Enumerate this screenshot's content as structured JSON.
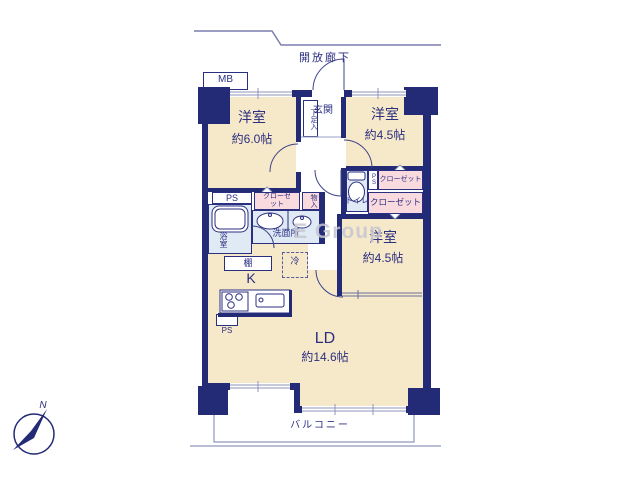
{
  "colors": {
    "wall": "#232a76",
    "room_fill": "#f6e9ca",
    "closet_fill": "#f9dade",
    "wet_area_fill": "#dfeaf4",
    "thin_line": "#8f96bb",
    "label_text": "#2b2f80",
    "watermark_text": "#c6c6d0"
  },
  "labels": {
    "open_corridor": "開放廊下",
    "meter_box": "MB",
    "entrance": "玄関",
    "shoe_cabinet": "下足入",
    "room1": {
      "name": "洋室",
      "size": "約6.0帖"
    },
    "room2": {
      "name": "洋室",
      "size": "約4.5帖"
    },
    "room3": {
      "name": "洋室",
      "size": "約4.5帖"
    },
    "living_dining": {
      "name": "LD",
      "size": "約14.6帖"
    },
    "kitchen": "K",
    "bathroom": "浴室",
    "washroom": "洗面所",
    "toilet": "トイレ",
    "closet_left": "クローゼット",
    "closet_right_top": "クローゼット",
    "closet_right_mid": "クローゼット",
    "storage": "物入",
    "shelf": "棚",
    "refrigerator": "冷",
    "ps_left": "PS",
    "ps_kitchen": "PS",
    "ps_right": "PS",
    "balcony": "バルコニー",
    "north": "N",
    "watermark": "E Group"
  }
}
